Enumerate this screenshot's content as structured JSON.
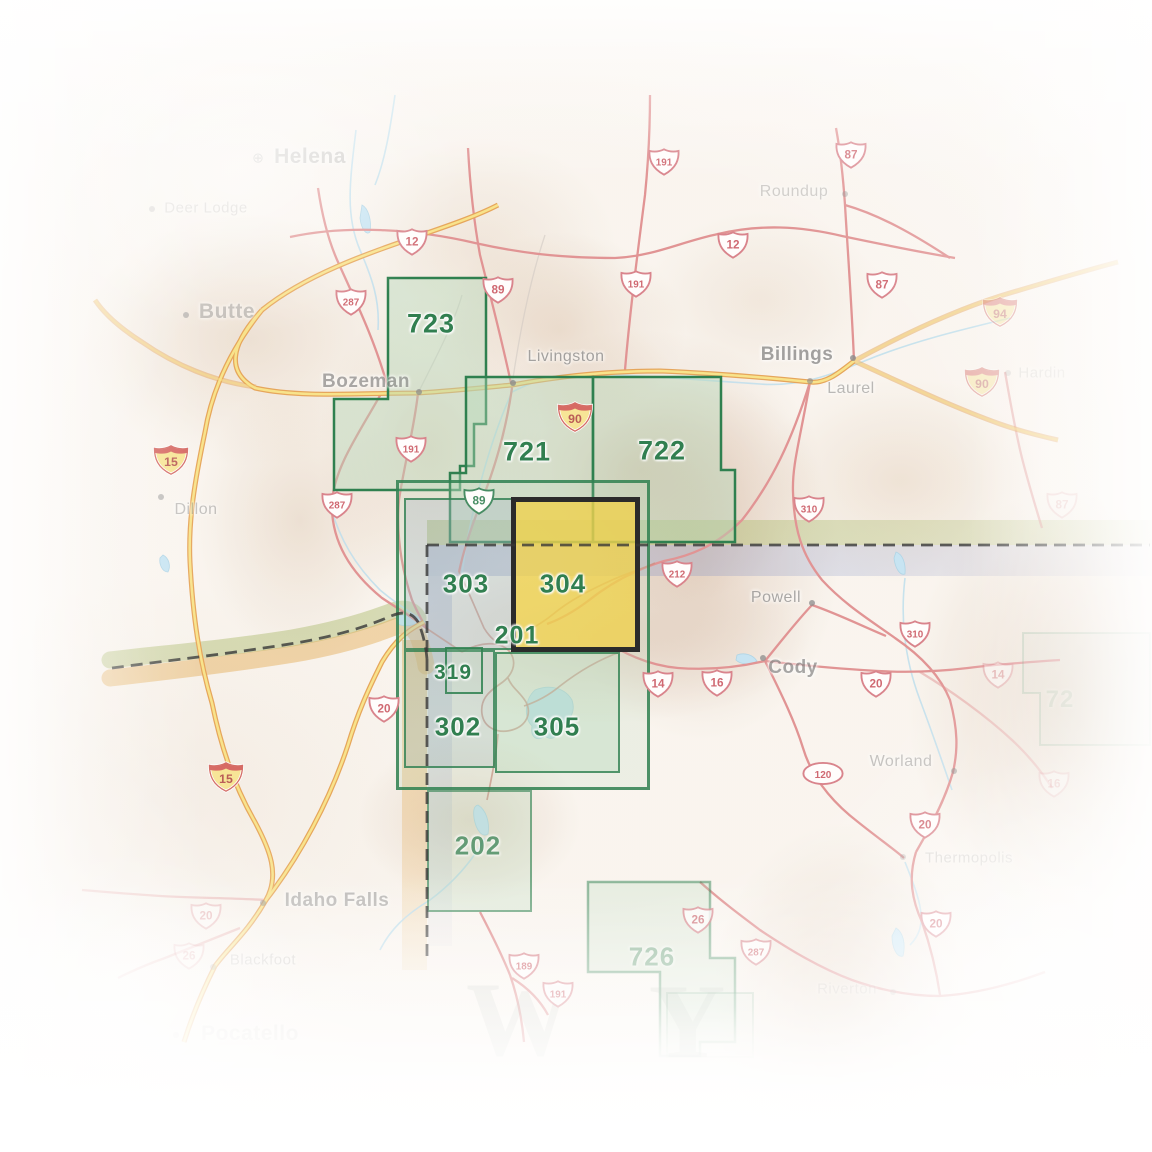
{
  "regions": [
    {
      "id": "723",
      "label": "723",
      "x": 431,
      "y": 324,
      "fs": 27,
      "op": 1
    },
    {
      "id": "721",
      "label": "721",
      "x": 527,
      "y": 452,
      "fs": 27,
      "op": 1
    },
    {
      "id": "722",
      "label": "722",
      "x": 662,
      "y": 451,
      "fs": 27,
      "op": 1
    },
    {
      "id": "303",
      "label": "303",
      "x": 466,
      "y": 584,
      "fs": 26,
      "op": 1
    },
    {
      "id": "304",
      "label": "304",
      "x": 563,
      "y": 584,
      "fs": 26,
      "op": 1
    },
    {
      "id": "201",
      "label": "201",
      "x": 517,
      "y": 636,
      "fs": 25,
      "op": 1
    },
    {
      "id": "319",
      "label": "319",
      "x": 453,
      "y": 673,
      "fs": 21,
      "op": 1
    },
    {
      "id": "302",
      "label": "302",
      "x": 458,
      "y": 727,
      "fs": 26,
      "op": 1
    },
    {
      "id": "305",
      "label": "305",
      "x": 557,
      "y": 727,
      "fs": 26,
      "op": 1
    },
    {
      "id": "202",
      "label": "202",
      "x": 478,
      "y": 846,
      "fs": 26,
      "op": 0.7
    },
    {
      "id": "726",
      "label": "726",
      "x": 652,
      "y": 957,
      "fs": 26,
      "op": 0.45
    },
    {
      "id": "727",
      "label": "72",
      "x": 1060,
      "y": 700,
      "fs": 24,
      "op": 0.14
    }
  ],
  "selected_region": {
    "id": "304",
    "highlight_color": "#eeca32",
    "border_color": "#0e0e0e"
  },
  "cities": [
    {
      "name": "Helena",
      "x": 310,
      "y": 157,
      "cls": "c-big",
      "op": 0.42,
      "dot": {
        "x": 258,
        "y": 158
      },
      "capital": true
    },
    {
      "name": "Deer Lodge",
      "x": 206,
      "y": 208,
      "cls": "c-med",
      "op": 0.3,
      "dot": {
        "x": 152,
        "y": 209
      }
    },
    {
      "name": "Butte",
      "x": 227,
      "y": 312,
      "cls": "c-big",
      "op": 0.5,
      "dot": {
        "x": 186,
        "y": 315
      }
    },
    {
      "name": "Bozeman",
      "x": 366,
      "y": 382,
      "cls": "c-big2",
      "op": 0.72,
      "dot": {
        "x": 419,
        "y": 392
      }
    },
    {
      "name": "Livingston",
      "x": 566,
      "y": 357,
      "cls": "c-med2",
      "op": 0.8,
      "dot": {
        "x": 513,
        "y": 383
      }
    },
    {
      "name": "Billings",
      "x": 797,
      "y": 355,
      "cls": "c-big2",
      "op": 0.8,
      "dot": {
        "x": 853,
        "y": 358
      }
    },
    {
      "name": "Laurel",
      "x": 851,
      "y": 389,
      "cls": "c-med2",
      "op": 0.6,
      "dot": {
        "x": 810,
        "y": 381
      }
    },
    {
      "name": "Roundup",
      "x": 794,
      "y": 192,
      "cls": "c-med2",
      "op": 0.4,
      "dot": {
        "x": 845,
        "y": 194
      }
    },
    {
      "name": "Hardin",
      "x": 1042,
      "y": 373,
      "cls": "c-med",
      "op": 0.18,
      "dot": {
        "x": 1008,
        "y": 373
      }
    },
    {
      "name": "Dillon",
      "x": 196,
      "y": 510,
      "cls": "c-med2",
      "op": 0.5,
      "dot": {
        "x": 161,
        "y": 497
      }
    },
    {
      "name": "Powell",
      "x": 776,
      "y": 598,
      "cls": "c-med2",
      "op": 0.75,
      "dot": {
        "x": 812,
        "y": 603
      }
    },
    {
      "name": "Cody",
      "x": 793,
      "y": 668,
      "cls": "c-big2",
      "op": 0.75,
      "dot": {
        "x": 763,
        "y": 658
      }
    },
    {
      "name": "Worland",
      "x": 901,
      "y": 762,
      "cls": "c-med2",
      "op": 0.5,
      "dot": {
        "x": 954,
        "y": 771
      }
    },
    {
      "name": "Thermopolis",
      "x": 969,
      "y": 858,
      "cls": "c-med",
      "op": 0.3,
      "dot": {
        "x": 903,
        "y": 857
      }
    },
    {
      "name": "Idaho Falls",
      "x": 337,
      "y": 901,
      "cls": "c-big2",
      "op": 0.55,
      "dot": {
        "x": 263,
        "y": 903
      }
    },
    {
      "name": "Blackfoot",
      "x": 263,
      "y": 960,
      "cls": "c-med",
      "op": 0.35,
      "dot": {
        "x": 213,
        "y": 967
      }
    },
    {
      "name": "Pocatello",
      "x": 250,
      "y": 1034,
      "cls": "c-big",
      "op": 0.2,
      "dot": {
        "x": 176,
        "y": 1035
      }
    },
    {
      "name": "Riverton",
      "x": 847,
      "y": 989,
      "cls": "c-med",
      "op": 0.28,
      "dot": {
        "x": 893,
        "y": 992
      }
    }
  ],
  "shields": [
    {
      "route": "12",
      "type": "us",
      "x": 395,
      "y": 227
    },
    {
      "route": "12",
      "type": "us",
      "x": 716,
      "y": 230
    },
    {
      "route": "191",
      "type": "us",
      "x": 647,
      "y": 147
    },
    {
      "route": "191",
      "type": "us",
      "x": 619,
      "y": 269
    },
    {
      "route": "87",
      "type": "us",
      "x": 834,
      "y": 140
    },
    {
      "route": "87",
      "type": "us",
      "x": 865,
      "y": 270
    },
    {
      "route": "287",
      "type": "us",
      "x": 334,
      "y": 287
    },
    {
      "route": "89",
      "type": "us",
      "x": 481,
      "y": 275
    },
    {
      "route": "90",
      "type": "int",
      "x": 556,
      "y": 400
    },
    {
      "route": "94",
      "type": "int",
      "x": 981,
      "y": 295,
      "op": 0.5
    },
    {
      "route": "90",
      "type": "int",
      "x": 963,
      "y": 365,
      "op": 0.45
    },
    {
      "route": "15",
      "type": "int",
      "x": 152,
      "y": 443
    },
    {
      "route": "15",
      "type": "int",
      "x": 207,
      "y": 760
    },
    {
      "route": "191",
      "type": "us",
      "x": 394,
      "y": 434
    },
    {
      "route": "287",
      "type": "us",
      "x": 320,
      "y": 490
    },
    {
      "route": "89",
      "type": "us-green",
      "x": 462,
      "y": 486
    },
    {
      "route": "310",
      "type": "us",
      "x": 792,
      "y": 494
    },
    {
      "route": "212",
      "type": "us",
      "x": 660,
      "y": 559
    },
    {
      "route": "310",
      "type": "us",
      "x": 898,
      "y": 619
    },
    {
      "route": "14",
      "type": "us",
      "x": 641,
      "y": 669
    },
    {
      "route": "16",
      "type": "us",
      "x": 700,
      "y": 668
    },
    {
      "route": "20",
      "type": "us",
      "x": 859,
      "y": 669
    },
    {
      "route": "14",
      "type": "us",
      "x": 981,
      "y": 660,
      "op": 0.45
    },
    {
      "route": "16",
      "type": "us",
      "x": 1037,
      "y": 769,
      "op": 0.3
    },
    {
      "route": "87",
      "type": "us",
      "x": 1045,
      "y": 490,
      "op": 0.22
    },
    {
      "route": "20",
      "type": "us",
      "x": 367,
      "y": 694
    },
    {
      "route": "120",
      "type": "oval",
      "x": 801,
      "y": 761
    },
    {
      "route": "20",
      "type": "us",
      "x": 908,
      "y": 810
    },
    {
      "route": "20",
      "type": "us",
      "x": 919,
      "y": 909
    },
    {
      "route": "20",
      "type": "us",
      "x": 189,
      "y": 901,
      "op": 0.45
    },
    {
      "route": "26",
      "type": "us",
      "x": 172,
      "y": 941,
      "op": 0.35
    },
    {
      "route": "26",
      "type": "us",
      "x": 681,
      "y": 905,
      "op": 0.8
    },
    {
      "route": "287",
      "type": "us",
      "x": 739,
      "y": 937,
      "op": 0.8
    },
    {
      "route": "189",
      "type": "us",
      "x": 507,
      "y": 951,
      "op": 0.9
    },
    {
      "route": "191",
      "type": "us",
      "x": 541,
      "y": 979,
      "op": 0.85
    }
  ],
  "state_letters": [
    {
      "ch": "W",
      "x": 520,
      "y": 1020
    },
    {
      "ch": "Y",
      "x": 688,
      "y": 1022
    }
  ],
  "colors": {
    "region_border_green": "#126e37",
    "region_fill_green": "rgba(170,210,175,0.42)",
    "selected_yellow": "#eeca32",
    "band_montana": "#a0b258",
    "band_wyoming": "#7887be",
    "band_idaho": "#e1a03c",
    "road_interstate_fill": "#f7df7b",
    "road_interstate_case": "#e39a45",
    "road_us_red": "#dd8585",
    "water_blue": "#bfe0f0",
    "city_gray": "#8a8a8a"
  }
}
